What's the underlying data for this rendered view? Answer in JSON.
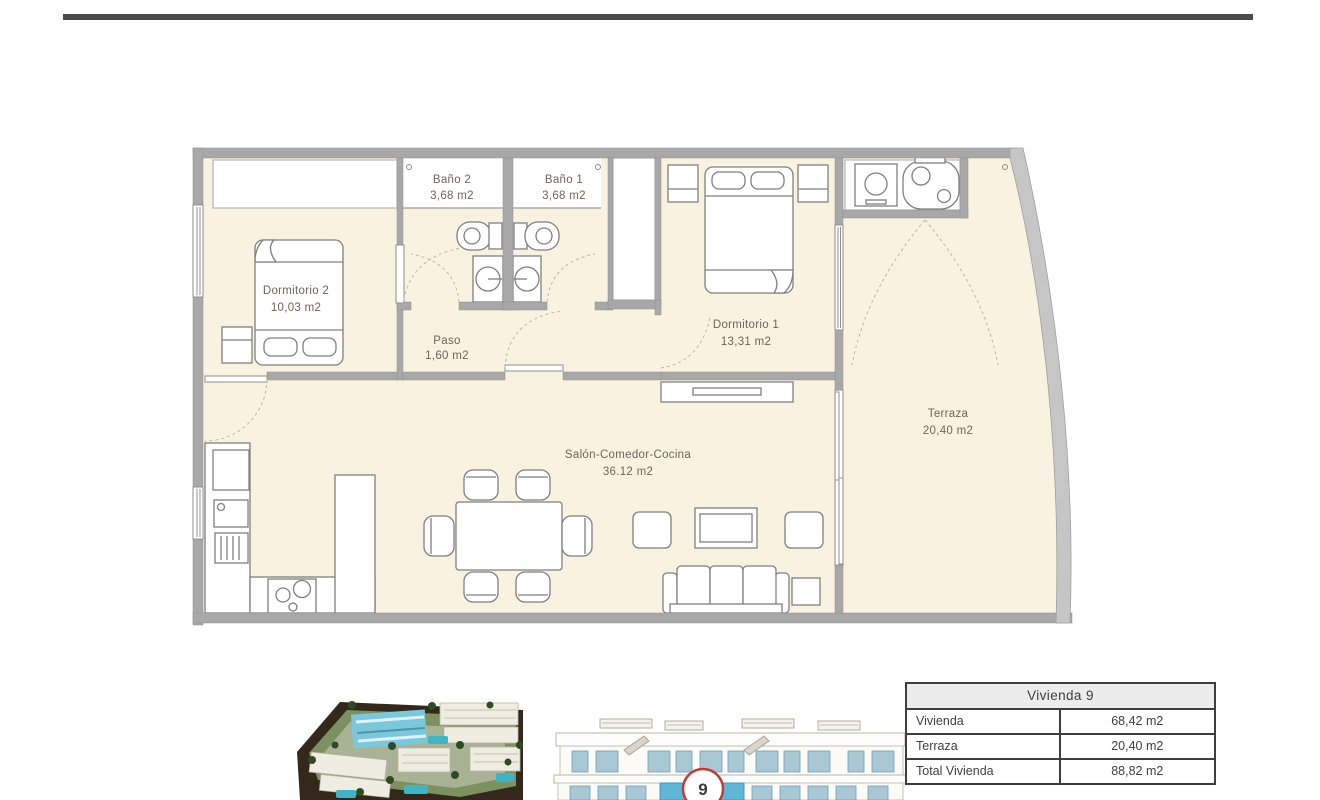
{
  "floor_plan": {
    "colors": {
      "room_fill": "#f9f2e0",
      "wall": "#a8a8a8",
      "label": "#6e655a"
    },
    "rooms": {
      "dormitorio2": {
        "name": "Dormitorio 2",
        "area": "10,03 m2"
      },
      "bano2": {
        "name": "Baño 2",
        "area": "3,68 m2"
      },
      "bano1": {
        "name": "Baño 1",
        "area": "3,68 m2"
      },
      "paso": {
        "name": "Paso",
        "area": "1,60 m2"
      },
      "dormitorio1": {
        "name": "Dormitorio 1",
        "area": "13,31 m2"
      },
      "salon": {
        "name": "Salón-Comedor-Cocina",
        "area": "36.12 m2"
      },
      "terraza": {
        "name": "Terraza",
        "area": "20,40 m2"
      }
    }
  },
  "unit_badge": {
    "number": "9",
    "ring_color": "#c23b38"
  },
  "summary_table": {
    "header": "Vivienda 9",
    "rows": [
      {
        "label": "Vivienda",
        "value": "68,42 m2"
      },
      {
        "label": "Terraza",
        "value": "20,40 m2"
      },
      {
        "label": "Total Vivienda",
        "value": "88,82 m2"
      }
    ]
  }
}
